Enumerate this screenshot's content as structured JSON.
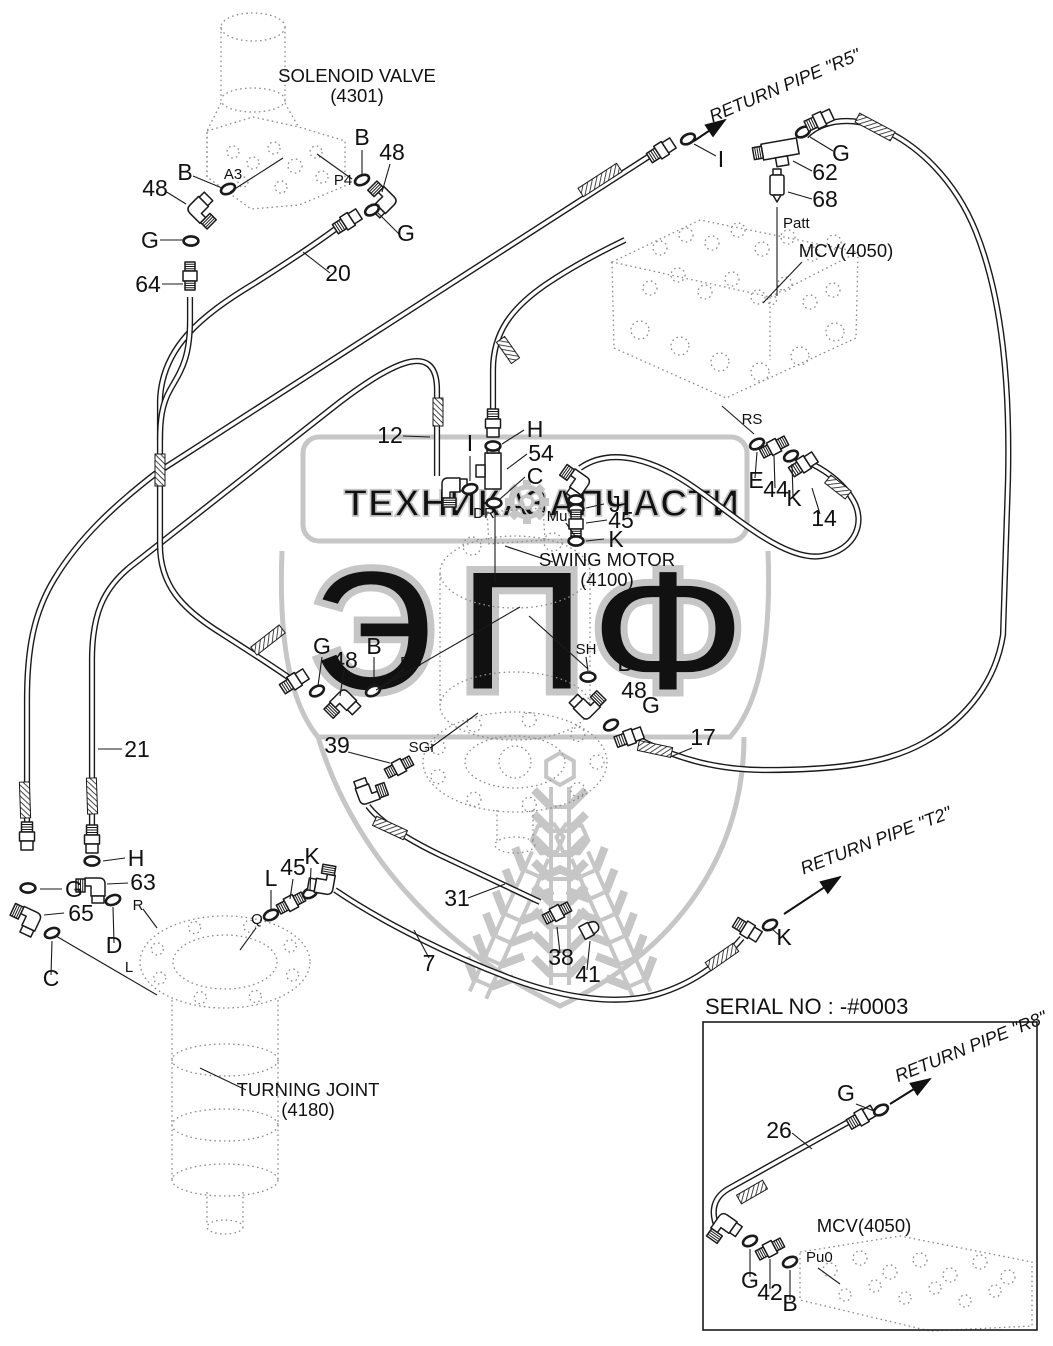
{
  "page": {
    "background": "#ffffff",
    "line_color": "#1a1a1a",
    "watermark_color": "#c6c6c6"
  },
  "diagram": {
    "component_labels": [
      {
        "text": "SOLENOID VALVE",
        "x": 357,
        "y": 82
      },
      {
        "text": "(4301)",
        "x": 357,
        "y": 102
      },
      {
        "text": "MCV(4050)",
        "x": 846,
        "y": 257
      },
      {
        "text": "SWING MOTOR",
        "x": 607,
        "y": 566
      },
      {
        "text": "(4100)",
        "x": 607,
        "y": 586
      },
      {
        "text": "TURNING JOINT",
        "x": 308,
        "y": 1096
      },
      {
        "text": "(4180)",
        "x": 308,
        "y": 1116
      },
      {
        "text": "MCV(4050)",
        "x": 864,
        "y": 1232
      }
    ],
    "part_labels": [
      {
        "text": "B",
        "x": 185,
        "y": 180
      },
      {
        "text": "48",
        "x": 155,
        "y": 196
      },
      {
        "text": "B",
        "x": 362,
        "y": 145
      },
      {
        "text": "48",
        "x": 392,
        "y": 160
      },
      {
        "text": "G",
        "x": 150,
        "y": 248
      },
      {
        "text": "G",
        "x": 406,
        "y": 241
      },
      {
        "text": "64",
        "x": 148,
        "y": 292
      },
      {
        "text": "20",
        "x": 338,
        "y": 281
      },
      {
        "text": "I",
        "x": 721,
        "y": 167
      },
      {
        "text": "G",
        "x": 841,
        "y": 161
      },
      {
        "text": "62",
        "x": 825,
        "y": 180
      },
      {
        "text": "68",
        "x": 825,
        "y": 207
      },
      {
        "text": "12",
        "x": 390,
        "y": 443
      },
      {
        "text": "I",
        "x": 470,
        "y": 451
      },
      {
        "text": "H",
        "x": 535,
        "y": 437
      },
      {
        "text": "54",
        "x": 541,
        "y": 461
      },
      {
        "text": "C",
        "x": 535,
        "y": 484
      },
      {
        "text": "J",
        "x": 615,
        "y": 512
      },
      {
        "text": "45",
        "x": 621,
        "y": 528
      },
      {
        "text": "K",
        "x": 616,
        "y": 547
      },
      {
        "text": "E",
        "x": 756,
        "y": 488
      },
      {
        "text": "44",
        "x": 776,
        "y": 497
      },
      {
        "text": "K",
        "x": 794,
        "y": 506
      },
      {
        "text": "14",
        "x": 824,
        "y": 526
      },
      {
        "text": "G",
        "x": 322,
        "y": 654
      },
      {
        "text": "48",
        "x": 345,
        "y": 668
      },
      {
        "text": "B",
        "x": 374,
        "y": 654
      },
      {
        "text": "21",
        "x": 137,
        "y": 757
      },
      {
        "text": "39",
        "x": 337,
        "y": 753
      },
      {
        "text": "B",
        "x": 625,
        "y": 671
      },
      {
        "text": "48",
        "x": 634,
        "y": 698
      },
      {
        "text": "G",
        "x": 651,
        "y": 713
      },
      {
        "text": "17",
        "x": 703,
        "y": 745
      },
      {
        "text": "H",
        "x": 136,
        "y": 866
      },
      {
        "text": "63",
        "x": 143,
        "y": 890
      },
      {
        "text": "G",
        "x": 74,
        "y": 897
      },
      {
        "text": "65",
        "x": 81,
        "y": 921
      },
      {
        "text": "D",
        "x": 114,
        "y": 953
      },
      {
        "text": "C",
        "x": 51,
        "y": 986
      },
      {
        "text": "L",
        "x": 271,
        "y": 886
      },
      {
        "text": "45",
        "x": 293,
        "y": 875
      },
      {
        "text": "K",
        "x": 312,
        "y": 864
      },
      {
        "text": "31",
        "x": 457,
        "y": 906
      },
      {
        "text": "7",
        "x": 429,
        "y": 971
      },
      {
        "text": "38",
        "x": 561,
        "y": 965
      },
      {
        "text": "41",
        "x": 588,
        "y": 982
      },
      {
        "text": "K",
        "x": 784,
        "y": 945
      },
      {
        "text": "G",
        "x": 846,
        "y": 1101
      },
      {
        "text": "26",
        "x": 779,
        "y": 1138
      },
      {
        "text": "G",
        "x": 750,
        "y": 1288
      },
      {
        "text": "42",
        "x": 770,
        "y": 1300
      },
      {
        "text": "B",
        "x": 790,
        "y": 1311
      }
    ],
    "port_labels": [
      {
        "text": "A3",
        "x": 233,
        "y": 179
      },
      {
        "text": "P4",
        "x": 343,
        "y": 185
      },
      {
        "text": "Patt",
        "x": 783,
        "y": 228,
        "anchor": "start"
      },
      {
        "text": "DR",
        "x": 484,
        "y": 518
      },
      {
        "text": "Mu",
        "x": 557,
        "y": 521
      },
      {
        "text": "RS",
        "x": 752,
        "y": 424
      },
      {
        "text": "PG",
        "x": 411,
        "y": 667
      },
      {
        "text": "SH",
        "x": 586,
        "y": 654
      },
      {
        "text": "SGr",
        "x": 422,
        "y": 752
      },
      {
        "text": "R",
        "x": 138,
        "y": 910
      },
      {
        "text": "L",
        "x": 129,
        "y": 972
      },
      {
        "text": "Q",
        "x": 257,
        "y": 924
      },
      {
        "text": "Pu0",
        "x": 806,
        "y": 1262,
        "anchor": "start"
      }
    ],
    "flow_labels": [
      {
        "text": "RETURN PIPE \"R5\"",
        "x": 787,
        "y": 91,
        "rot": -23
      },
      {
        "text": "RETURN PIPE \"T2\"",
        "x": 878,
        "y": 846,
        "rot": -21
      },
      {
        "text": "RETURN PIPE \"R8\"",
        "x": 973,
        "y": 1052,
        "rot": -22
      }
    ],
    "inset_title": {
      "text": "SERIAL NO : -#0003",
      "x": 705,
      "y": 1014
    }
  },
  "watermark": {
    "band_left": "ТЕХНИКА",
    "band_right": "ЗАПЧАСТИ",
    "letters": [
      {
        "text": "Э",
        "x": 375,
        "y": 692
      },
      {
        "text": "П",
        "x": 522,
        "y": 692
      },
      {
        "text": "Ф",
        "x": 668,
        "y": 692
      }
    ],
    "gear_icon": "gear-icon",
    "color": "#c6c6c6"
  }
}
